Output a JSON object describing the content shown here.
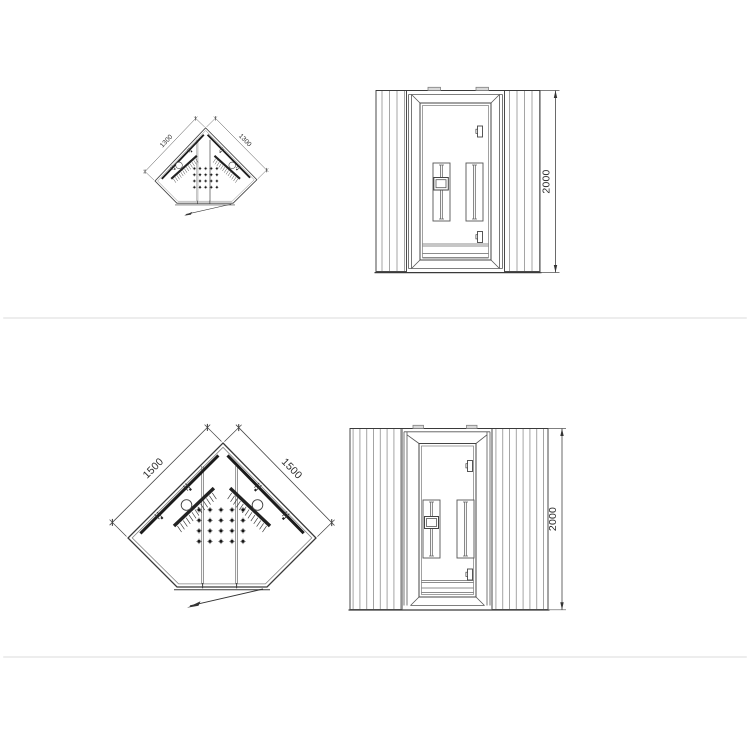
{
  "page": {
    "background": "#ffffff",
    "divider_color": "#ededed",
    "line_color": "#3a3a3a",
    "heater_band_color": "#1b1b1b",
    "cap_fill_color": "#d9d9d9"
  },
  "drawings": {
    "row1": {
      "plan": {
        "dim_left": "1300",
        "dim_right": "1300"
      },
      "front": {
        "dim_height": "2000"
      }
    },
    "row2": {
      "plan": {
        "dim_left": "1500",
        "dim_right": "1500"
      },
      "front": {
        "dim_height": "2000"
      }
    }
  }
}
